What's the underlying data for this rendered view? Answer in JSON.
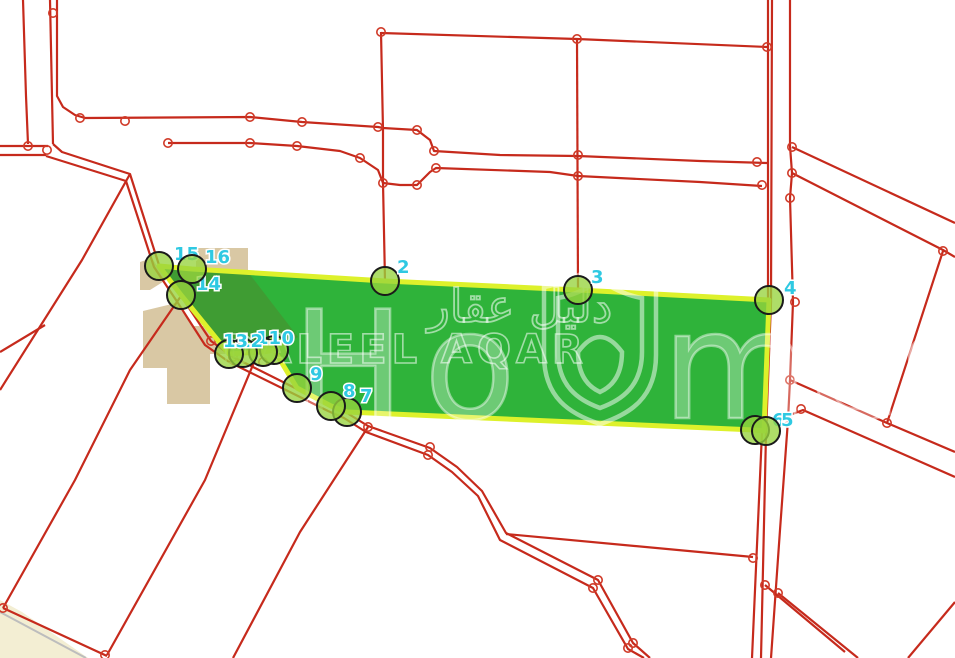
{
  "map": {
    "colors": {
      "background": "#ffffff",
      "parcel_line_red": "#c62a1c",
      "node_red": "#d03a28",
      "plot_fill_green": "#2fb33a",
      "plot_overlap_green": "#3f9c33",
      "plot_border_yellow": "#ddf12b",
      "marker_fill": "rgba(151,211,61,0.78)",
      "marker_ring": "#1a1a1a",
      "label_cyan": "#2fc9e2",
      "building_tan": "#d9c8a4",
      "corner_cream": "#f3eed3",
      "gray_line": "#bdbdbd",
      "watermark_white": "rgba(255,255,255,0.5)"
    },
    "watermark": {
      "arabic": "دليل عقار",
      "latin": "DALEEL AQAR",
      "brand_h": "H",
      "brand_o": "o",
      "brand_mes": "mes",
      "shield": "shield-logo-icon"
    },
    "plot": {
      "points": [
        [
          192,
          269
        ],
        [
          385,
          281
        ],
        [
          578,
          290
        ],
        [
          769,
          300
        ],
        [
          764,
          431
        ],
        [
          755,
          430
        ],
        [
          347,
          412
        ],
        [
          331,
          406
        ],
        [
          297,
          388
        ],
        [
          274,
          350
        ],
        [
          263,
          352
        ],
        [
          243,
          353
        ],
        [
          229,
          354
        ],
        [
          181,
          295
        ],
        [
          159,
          266
        ]
      ]
    },
    "overlap_patch": {
      "points": [
        [
          192,
          270
        ],
        [
          248,
          272
        ],
        [
          298,
          337
        ],
        [
          274,
          350
        ],
        [
          263,
          352
        ],
        [
          243,
          353
        ],
        [
          229,
          354
        ],
        [
          181,
          296
        ],
        [
          159,
          267
        ]
      ]
    },
    "vertex_markers": [
      {
        "label": "2",
        "x": 385,
        "y": 281,
        "lx": 397,
        "ly": 273
      },
      {
        "label": "3",
        "x": 578,
        "y": 290,
        "lx": 591,
        "ly": 283
      },
      {
        "label": "4",
        "x": 769,
        "y": 300,
        "lx": 784,
        "ly": 294
      },
      {
        "label": "6",
        "x": 755,
        "y": 430,
        "lx": 772,
        "ly": 426
      },
      {
        "label": "5",
        "x": 766,
        "y": 431,
        "lx": 781,
        "ly": 426
      },
      {
        "label": "7",
        "x": 347,
        "y": 412,
        "lx": 360,
        "ly": 402
      },
      {
        "label": "8",
        "x": 331,
        "y": 406,
        "lx": 343,
        "ly": 397
      },
      {
        "label": "9",
        "x": 297,
        "y": 388,
        "lx": 310,
        "ly": 380
      },
      {
        "label": "10",
        "x": 274,
        "y": 350,
        "lx": 269,
        "ly": 344
      },
      {
        "label": "11",
        "x": 263,
        "y": 352,
        "lx": 256,
        "ly": 344
      },
      {
        "label": "12",
        "x": 243,
        "y": 353,
        "lx": 238,
        "ly": 347
      },
      {
        "label": "13",
        "x": 229,
        "y": 354,
        "lx": 223,
        "ly": 347
      },
      {
        "label": "14",
        "x": 181,
        "y": 295,
        "lx": 196,
        "ly": 290
      },
      {
        "label": "15",
        "x": 159,
        "y": 266,
        "lx": 174,
        "ly": 260
      },
      {
        "label": "16",
        "x": 192,
        "y": 269,
        "lx": 205,
        "ly": 263
      }
    ],
    "tan_shapes": [
      [
        [
          196,
          248
        ],
        [
          248,
          248
        ],
        [
          248,
          272
        ],
        [
          196,
          270
        ]
      ],
      [
        [
          140,
          262
        ],
        [
          152,
          258
        ],
        [
          166,
          280
        ],
        [
          150,
          290
        ],
        [
          140,
          290
        ]
      ],
      [
        [
          143,
          311
        ],
        [
          176,
          303
        ],
        [
          192,
          326
        ],
        [
          233,
          326
        ],
        [
          233,
          354
        ],
        [
          210,
          354
        ],
        [
          210,
          404
        ],
        [
          167,
          404
        ],
        [
          167,
          368
        ],
        [
          143,
          368
        ]
      ]
    ],
    "cream_shape": [
      [
        0,
        600
      ],
      [
        22,
        612
      ],
      [
        88,
        658
      ],
      [
        0,
        658
      ]
    ],
    "gray_lines": [
      [
        [
          0,
          612
        ],
        [
          86,
          658
        ]
      ]
    ],
    "roads": [
      [
        [
          23,
          0
        ],
        [
          26,
          96
        ],
        [
          28,
          144
        ]
      ],
      [
        [
          50,
          0
        ],
        [
          53,
          144
        ]
      ],
      [
        [
          57,
          0
        ],
        [
          57,
          96
        ],
        [
          63,
          107
        ],
        [
          75,
          115
        ],
        [
          85,
          118
        ],
        [
          250,
          117
        ],
        [
          302,
          122
        ],
        [
          378,
          127
        ],
        [
          383,
          128
        ],
        [
          417,
          130
        ],
        [
          430,
          140
        ],
        [
          434,
          151
        ],
        [
          500,
          155
        ],
        [
          578,
          156
        ],
        [
          700,
          161
        ],
        [
          767,
          163
        ]
      ],
      [
        [
          0,
          146
        ],
        [
          48,
          146
        ]
      ],
      [
        [
          0,
          155
        ],
        [
          46,
          155
        ]
      ],
      [
        [
          53,
          144
        ],
        [
          62,
          152
        ],
        [
          130,
          174
        ],
        [
          159,
          265
        ],
        [
          181,
          296
        ],
        [
          211,
          341
        ],
        [
          233,
          357
        ],
        [
          297,
          389
        ],
        [
          331,
          406
        ],
        [
          347,
          413
        ],
        [
          368,
          426
        ],
        [
          430,
          448
        ],
        [
          457,
          467
        ],
        [
          482,
          491
        ],
        [
          506,
          533
        ],
        [
          598,
          580
        ],
        [
          633,
          643
        ],
        [
          650,
          658
        ]
      ],
      [
        [
          46,
          156
        ],
        [
          126,
          181
        ],
        [
          154,
          267
        ],
        [
          176,
          300
        ],
        [
          205,
          345
        ],
        [
          229,
          362
        ],
        [
          294,
          394
        ],
        [
          328,
          411
        ],
        [
          344,
          418
        ],
        [
          366,
          432
        ],
        [
          428,
          455
        ],
        [
          452,
          472
        ],
        [
          478,
          496
        ],
        [
          500,
          540
        ],
        [
          593,
          588
        ],
        [
          628,
          649
        ],
        [
          644,
          658
        ]
      ],
      [
        [
          168,
          143
        ],
        [
          250,
          143
        ],
        [
          297,
          146
        ],
        [
          340,
          151
        ],
        [
          360,
          158
        ],
        [
          378,
          170
        ],
        [
          383,
          183
        ],
        [
          400,
          185
        ],
        [
          417,
          185
        ],
        [
          430,
          172
        ],
        [
          436,
          168
        ],
        [
          550,
          172
        ],
        [
          578,
          176
        ],
        [
          700,
          182
        ],
        [
          762,
          186
        ]
      ],
      [
        [
          381,
          33
        ],
        [
          577,
          39
        ],
        [
          767,
          47
        ]
      ],
      [
        [
          381,
          32
        ],
        [
          383,
          130
        ],
        [
          383,
          183
        ],
        [
          385,
          281
        ]
      ],
      [
        [
          577,
          39
        ],
        [
          578,
          290
        ]
      ],
      [
        [
          130,
          174
        ],
        [
          82,
          260
        ],
        [
          0,
          390
        ]
      ],
      [
        [
          45,
          325
        ],
        [
          0,
          352
        ]
      ],
      [
        [
          181,
          296
        ],
        [
          130,
          370
        ],
        [
          75,
          480
        ],
        [
          3,
          608
        ]
      ],
      [
        [
          3,
          608
        ],
        [
          107,
          656
        ]
      ],
      [
        [
          255,
          360
        ],
        [
          205,
          480
        ],
        [
          107,
          655
        ]
      ],
      [
        [
          368,
          427
        ],
        [
          300,
          532
        ],
        [
          233,
          658
        ]
      ],
      [
        [
          768,
          0
        ],
        [
          768,
          300
        ],
        [
          762,
          432
        ],
        [
          752,
          658
        ]
      ],
      [
        [
          772,
          0
        ],
        [
          771,
          302
        ],
        [
          766,
          434
        ],
        [
          761,
          658
        ]
      ],
      [
        [
          790,
          0
        ],
        [
          790,
          146
        ],
        [
          792,
          173
        ],
        [
          790,
          198
        ],
        [
          793,
          302
        ],
        [
          790,
          380
        ],
        [
          788,
          420
        ],
        [
          780,
          530
        ],
        [
          771,
          658
        ]
      ],
      [
        [
          792,
          147
        ],
        [
          955,
          223
        ]
      ],
      [
        [
          792,
          173
        ],
        [
          943,
          250
        ],
        [
          955,
          257
        ]
      ],
      [
        [
          943,
          251
        ],
        [
          887,
          423
        ]
      ],
      [
        [
          790,
          380
        ],
        [
          887,
          423
        ],
        [
          955,
          452
        ]
      ],
      [
        [
          790,
          415
        ],
        [
          803,
          410
        ],
        [
          955,
          477
        ]
      ],
      [
        [
          506,
          534
        ],
        [
          753,
          557
        ]
      ],
      [
        [
          765,
          585
        ],
        [
          845,
          652
        ]
      ],
      [
        [
          778,
          593
        ],
        [
          858,
          658
        ]
      ],
      [
        [
          955,
          602
        ],
        [
          908,
          658
        ]
      ]
    ],
    "road_nodes": [
      [
        28,
        146
      ],
      [
        47,
        150
      ],
      [
        53,
        13
      ],
      [
        80,
        118
      ],
      [
        125,
        121
      ],
      [
        168,
        143
      ],
      [
        250,
        117
      ],
      [
        250,
        143
      ],
      [
        297,
        146
      ],
      [
        302,
        122
      ],
      [
        360,
        158
      ],
      [
        378,
        127
      ],
      [
        417,
        130
      ],
      [
        434,
        151
      ],
      [
        383,
        183
      ],
      [
        417,
        185
      ],
      [
        436,
        168
      ],
      [
        577,
        39
      ],
      [
        578,
        155
      ],
      [
        578,
        176
      ],
      [
        767,
        47
      ],
      [
        757,
        162
      ],
      [
        762,
        185
      ],
      [
        381,
        32
      ],
      [
        792,
        147
      ],
      [
        792,
        173
      ],
      [
        790,
        198
      ],
      [
        943,
        251
      ],
      [
        795,
        302
      ],
      [
        790,
        380
      ],
      [
        887,
        423
      ],
      [
        801,
        409
      ],
      [
        788,
        420
      ],
      [
        753,
        558
      ],
      [
        765,
        585
      ],
      [
        778,
        593
      ],
      [
        598,
        580
      ],
      [
        593,
        588
      ],
      [
        633,
        643
      ],
      [
        628,
        648
      ],
      [
        430,
        447
      ],
      [
        428,
        455
      ],
      [
        368,
        427
      ],
      [
        263,
        362
      ],
      [
        3,
        608
      ],
      [
        233,
        357
      ],
      [
        211,
        341
      ],
      [
        105,
        655
      ]
    ]
  }
}
